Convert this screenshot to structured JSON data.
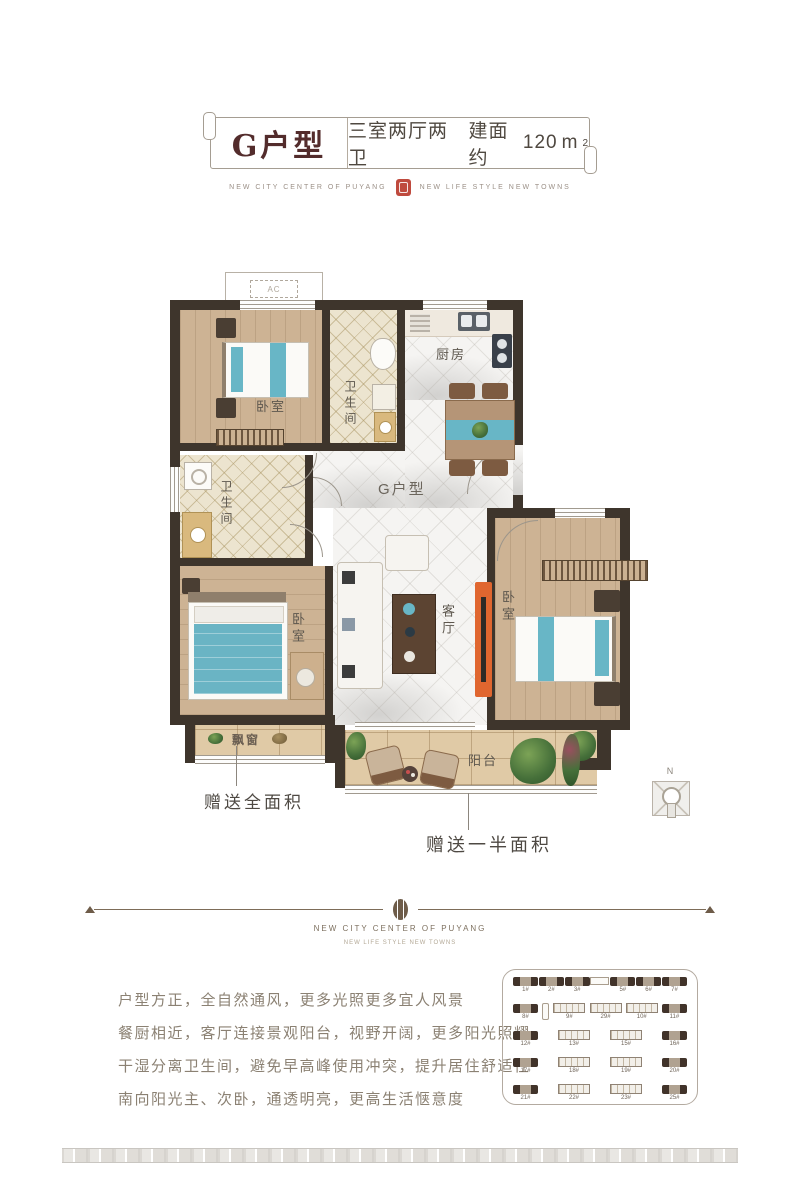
{
  "header": {
    "unit_name": "G户型",
    "unit_spec": "三室两厅两卫",
    "area_prefix": "建面约",
    "area_value": "120",
    "area_unit": "m",
    "area_sup": "2",
    "brand_left": "NEW CITY CENTER OF PUYANG",
    "brand_right": "NEW LIFE STYLE NEW TOWNS"
  },
  "floorplan": {
    "ac_label": "AC",
    "rooms": {
      "bedroom_top": "卧室",
      "bath_top": "卫生间",
      "kitchen": "厨房",
      "bath_mid": "卫生间",
      "bedroom_master": "卧室",
      "living": "客厅",
      "bedroom_right": "卧室",
      "hall_unit": "G户型",
      "balcony": "阳台",
      "bay_window": "飘窗"
    },
    "annotations": {
      "full_area": "赠送全面积",
      "half_area": "赠送一半面积"
    },
    "compass_label": "N"
  },
  "divider": {
    "brand_title": "NEW CITY CENTER OF PUYANG",
    "brand_subtitle": "NEW LIFE STYLE NEW TOWNS"
  },
  "description": {
    "lines": [
      "户型方正，全自然通风，更多光照更多宜人风景",
      "餐厨相近，客厅连接景观阳台，视野开阔，更多阳光照耀",
      "干湿分离卫生间，避免早高峰使用冲突，提升居住舒适性",
      "南向阳光主、次卧，通透明亮，更高生活惬意度"
    ]
  },
  "siteplan": {
    "rows": [
      [
        {
          "label": "1#",
          "type": "solid"
        },
        {
          "label": "2#",
          "type": "solid"
        },
        {
          "label": "3#",
          "type": "solid"
        },
        {
          "label": "",
          "type": "mark"
        },
        {
          "label": "5#",
          "type": "solid"
        },
        {
          "label": "6#",
          "type": "solid"
        },
        {
          "label": "7#",
          "type": "solid"
        }
      ],
      [
        {
          "label": "8#",
          "type": "solid"
        },
        {
          "label": "",
          "type": "markv"
        },
        {
          "label": "9#",
          "type": "outline"
        },
        {
          "label": "29#",
          "type": "outline"
        },
        {
          "label": "10#",
          "type": "outline"
        },
        {
          "label": "11#",
          "type": "solid"
        }
      ],
      [
        {
          "label": "12#",
          "type": "solid"
        },
        {
          "label": "13#",
          "type": "outline"
        },
        {
          "label": "15#",
          "type": "outline"
        },
        {
          "label": "16#",
          "type": "solid"
        }
      ],
      [
        {
          "label": "17#",
          "type": "solid"
        },
        {
          "label": "18#",
          "type": "outline"
        },
        {
          "label": "19#",
          "type": "outline"
        },
        {
          "label": "20#",
          "type": "solid"
        }
      ],
      [
        {
          "label": "21#",
          "type": "solid"
        },
        {
          "label": "22#",
          "type": "outline"
        },
        {
          "label": "23#",
          "type": "outline"
        },
        {
          "label": "25#",
          "type": "solid"
        }
      ]
    ]
  },
  "colors": {
    "title_maroon": "#532c2c",
    "seal_red": "#bf4a3e",
    "wall": "#3e352c",
    "teal_accent": "#68b6c6",
    "tv_orange": "#e0662f",
    "wood_floor": "#cdb394",
    "tile_floor": "#ece4cf",
    "balcony_tan": "#e0caa6",
    "text_brown": "#8b8173",
    "divider_brown": "#6e5c49"
  }
}
